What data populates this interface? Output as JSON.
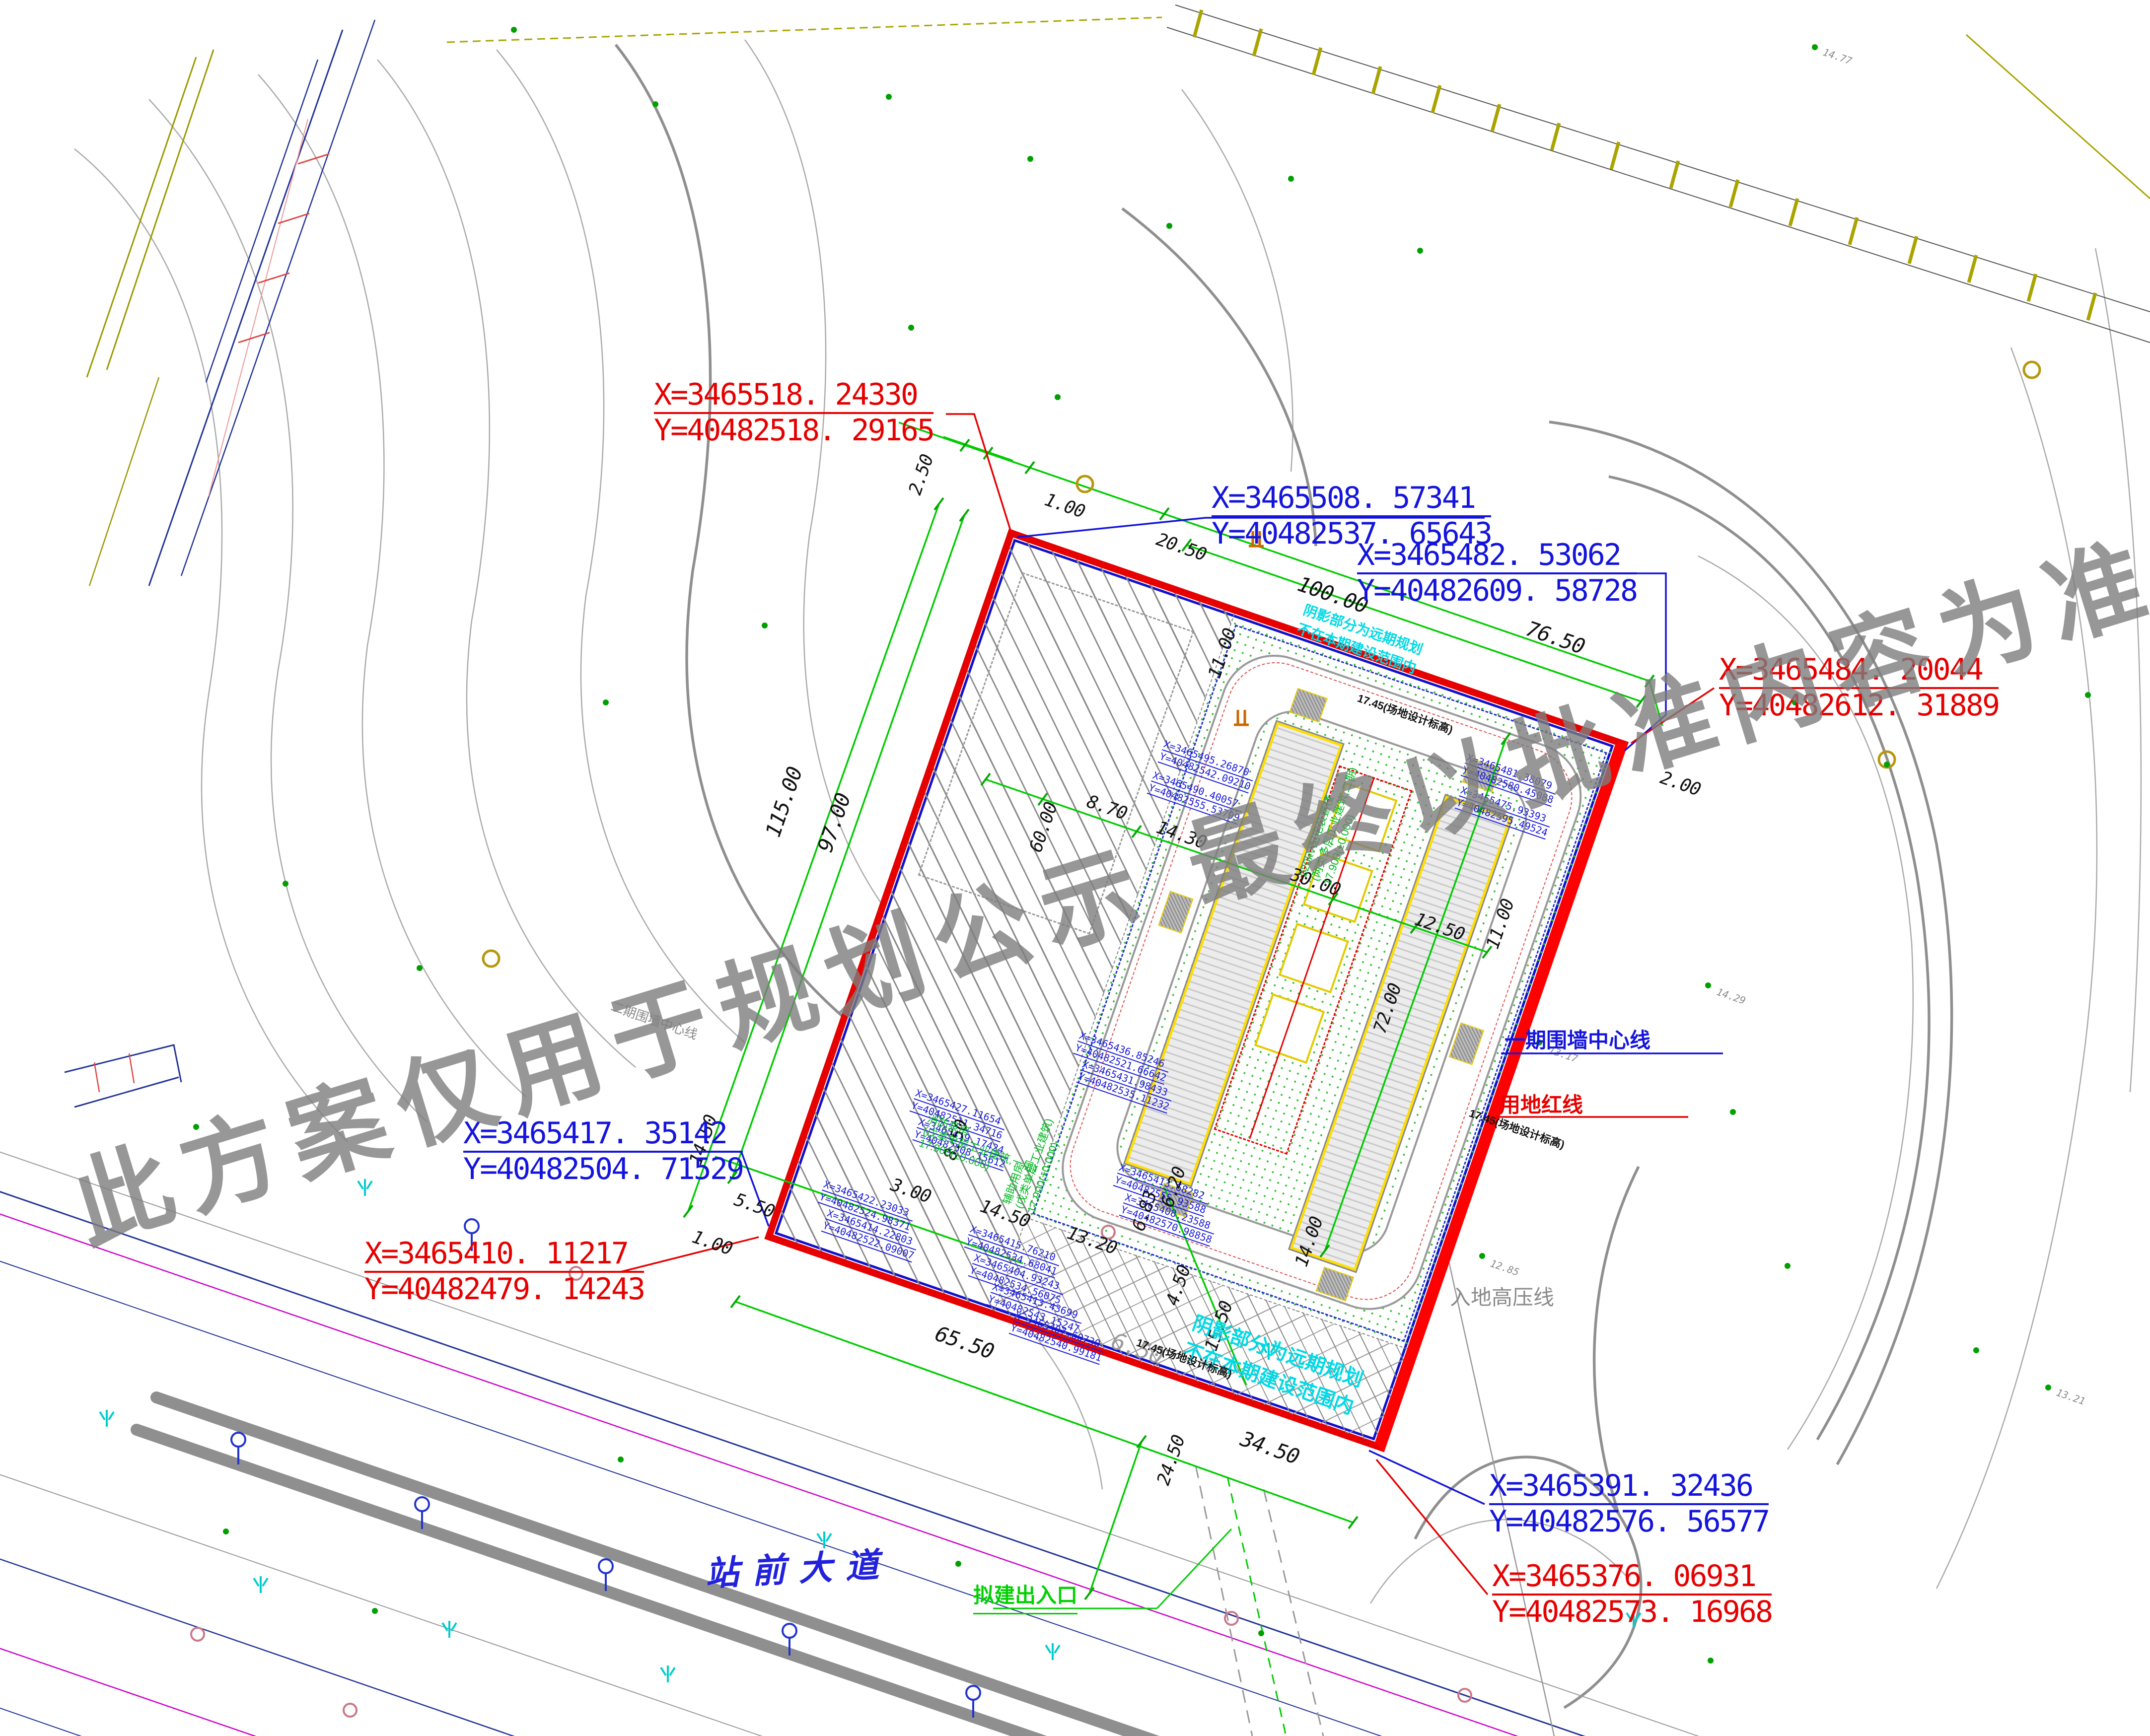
{
  "watermark": {
    "text": "此方案仅用于规划公示 最终以批准内容为准"
  },
  "road": {
    "main": "站前大道",
    "entrance": "拟建出入口",
    "hv": "入地高压线"
  },
  "lines": {
    "phase1_wall": "一期围墙中心线",
    "phase2_wall": "二期围墙中心线",
    "red_line": "用地红线"
  },
  "notes": {
    "shadow1": "阴影部分为远期规划",
    "shadow2": "不在本期建设范围内",
    "level": "17.45(场地设计标高)"
  },
  "buildings": [
    {
      "name": "消防泵房",
      "desc": "(戊类单层工业建筑,一层)",
      "level": "17.900(±0.000)"
    },
    {
      "name": "辅助用房",
      "desc": "(戊类单层工业建筑)",
      "level": "17.900(±0.000)"
    },
    {
      "name": "220kV配电装置楼",
      "desc": "(两类多层工业建筑,二期)",
      "level": "17.900(±0.000)"
    }
  ],
  "callouts": [
    {
      "color": "red",
      "x": "X=3465518. 24330",
      "y": "Y=40482518. 29165"
    },
    {
      "color": "blue",
      "x": "X=3465508. 57341",
      "y": "Y=40482537. 65643"
    },
    {
      "color": "blue",
      "x": "X=3465482. 53062",
      "y": "Y=40482609. 58728"
    },
    {
      "color": "red",
      "x": "X=3465484. 20044",
      "y": "Y=40482612. 31889"
    },
    {
      "color": "blue",
      "x": "X=3465417. 35142",
      "y": "Y=40482504. 71529"
    },
    {
      "color": "red",
      "x": "X=3465410. 11217",
      "y": "Y=40482479. 14243"
    },
    {
      "color": "blue",
      "x": "X=3465391. 32436",
      "y": "Y=40482576. 56577"
    },
    {
      "color": "red",
      "x": "X=3465376. 06931",
      "y": "Y=40482573. 16968"
    }
  ],
  "inner_coords": [
    {
      "x": "X=3465495.26870",
      "y": "Y=40482542.09210"
    },
    {
      "x": "X=3465490.40057",
      "y": "Y=40482555.53799"
    },
    {
      "x": "X=3465481.38079",
      "y": "Y=40482580.45088"
    },
    {
      "x": "X=3465475.93393",
      "y": "Y=40482595.49524"
    },
    {
      "x": "X=3465436.85246",
      "y": "Y=40482521.66642"
    },
    {
      "x": "X=3465431.98433",
      "y": "Y=40482535.11232"
    },
    {
      "x": "X=3465427.11654",
      "y": "Y=40482511.34716"
    },
    {
      "x": "X=3465419.17424",
      "y": "Y=40482508.15612"
    },
    {
      "x": "X=3465422.23033",
      "y": "Y=40482524.98371"
    },
    {
      "x": "X=3465414.22803",
      "y": "Y=40482522.09007"
    },
    {
      "x": "X=3465415.76210",
      "y": "Y=40482534.68041"
    },
    {
      "x": "X=3465404.93243",
      "y": "Y=40482534.56075"
    },
    {
      "x": "X=3465413.43699",
      "y": "Y=40482543.15247"
    },
    {
      "x": "X=3465407.60730",
      "y": "Y=40482540.99181"
    },
    {
      "x": "X=3465413.68282",
      "y": "Y=40482555.93588"
    },
    {
      "x": "X=3465408.23588",
      "y": "Y=40482570.98858"
    }
  ],
  "dims": [
    {
      "v": "2.50"
    },
    {
      "v": "1.00"
    },
    {
      "v": "20.50"
    },
    {
      "v": "100.00"
    },
    {
      "v": "76.50"
    },
    {
      "v": "2.00"
    },
    {
      "v": "115.00"
    },
    {
      "v": "97.00"
    },
    {
      "v": "11.00"
    },
    {
      "v": "8.70"
    },
    {
      "v": "14.30"
    },
    {
      "v": "30.00"
    },
    {
      "v": "12.50"
    },
    {
      "v": "11.00"
    },
    {
      "v": "72.00"
    },
    {
      "v": "60.00"
    },
    {
      "v": "14.50"
    },
    {
      "v": "5.50"
    },
    {
      "v": "1.00"
    },
    {
      "v": "3.00"
    },
    {
      "v": "14.50"
    },
    {
      "v": "8.50"
    },
    {
      "v": "13.20"
    },
    {
      "v": "6.83"
    },
    {
      "v": "6.20"
    },
    {
      "v": "4.50"
    },
    {
      "v": "15.50"
    },
    {
      "v": "65.50"
    },
    {
      "v": "34.50"
    },
    {
      "v": "24.50"
    },
    {
      "v": "14.00"
    },
    {
      "v": "6.50"
    }
  ],
  "spots": [
    {
      "v": "13.17"
    },
    {
      "v": "13.21"
    },
    {
      "v": "14.29"
    },
    {
      "v": "12.85"
    },
    {
      "v": "14.77"
    }
  ]
}
